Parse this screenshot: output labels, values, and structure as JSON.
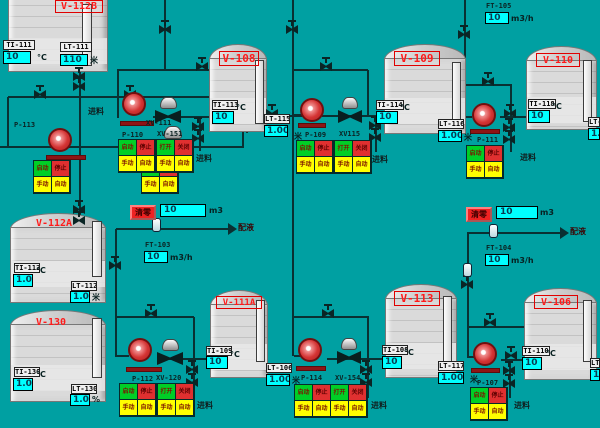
{
  "colors": {
    "background": "#00a0a2",
    "pipe": "#0a3032",
    "value_box": "#00ffff",
    "tank_name": "#ff1a1a",
    "pump_red": "#d43434",
    "cell_green": "#00cf26",
    "cell_red": "#e03030",
    "cell_yellow": "#ffff00",
    "reset_red": "#ee2222"
  },
  "strings": {
    "feed": "进料",
    "dosing": "配液",
    "reset": "清零",
    "unit_m3": "m3",
    "unit_m3h": "m3/h",
    "unit_c": "°C",
    "unit_m": "米",
    "unit_pct": "%"
  },
  "button_labels": {
    "pump": [
      "启动",
      "停止",
      "手动",
      "自动"
    ],
    "valve": [
      "打开",
      "关闭",
      "手动",
      "自动"
    ]
  },
  "tanks": [
    {
      "id": "v112b",
      "name": "V-112B",
      "boxed": true,
      "ti": {
        "tag": "TI-111",
        "value": "10",
        "unit": "°C"
      },
      "lt": {
        "tag": "LT-111",
        "value": "110",
        "unit": "米"
      }
    },
    {
      "id": "v108",
      "name": "V-108",
      "boxed": true,
      "ti": {
        "tag": "TI-113",
        "value": "10",
        "unit": "°C"
      },
      "lt": {
        "tag": "LT-115",
        "value": "1.00",
        "unit": "米"
      }
    },
    {
      "id": "v109",
      "name": "V-109",
      "boxed": true,
      "ti": {
        "tag": "TI-114",
        "value": "10",
        "unit": "°C"
      },
      "lt": {
        "tag": "LT-116",
        "value": "1.00",
        "unit": "米"
      }
    },
    {
      "id": "v110",
      "name": "V-110",
      "boxed": true,
      "ti": {
        "tag": "TI-118",
        "value": "10",
        "unit": "°C"
      },
      "lt": {
        "tag": "LT-1",
        "value": "1.0",
        "unit": ""
      }
    },
    {
      "id": "v112a",
      "name": "V-112A",
      "boxed": false,
      "ti": {
        "tag": "TI-112",
        "value": "1.0",
        "unit": "°C"
      },
      "lt": {
        "tag": "LT-112",
        "value": "1.00",
        "unit": "米"
      }
    },
    {
      "id": "v130",
      "name": "V-130",
      "boxed": false,
      "ti": {
        "tag": "TI-130",
        "value": "1.0",
        "unit": "°C"
      },
      "lt": {
        "tag": "LT-130",
        "value": "1.0",
        "unit": "%"
      }
    },
    {
      "id": "v111a",
      "name": "V-111A",
      "boxed": true,
      "ti": {
        "tag": "TI-109",
        "value": "10",
        "unit": "°C"
      },
      "lt": {
        "tag": "LT-106",
        "value": "1.00",
        "unit": "米"
      }
    },
    {
      "id": "v113",
      "name": "V-113",
      "boxed": true,
      "ti": {
        "tag": "TI-108",
        "value": "10",
        "unit": "°C"
      },
      "lt": {
        "tag": "LT-117",
        "value": "1.00",
        "unit": "米"
      }
    },
    {
      "id": "v106",
      "name": "V-106",
      "boxed": true,
      "ti": {
        "tag": "TI-110",
        "value": "10",
        "unit": "°C"
      },
      "lt": {
        "tag": "LT-1",
        "value": "1.0",
        "unit": ""
      }
    }
  ],
  "pumps": [
    {
      "id": "p113",
      "tag": "P-113"
    },
    {
      "id": "p110",
      "tag": "P-110"
    },
    {
      "id": "p109",
      "tag": "P-109"
    },
    {
      "id": "p111",
      "tag": "P-111"
    },
    {
      "id": "p112",
      "tag": "P-112"
    },
    {
      "id": "p114",
      "tag": "P-114"
    },
    {
      "id": "p107",
      "tag": "P-107"
    }
  ],
  "xvalves": [
    {
      "id": "xv111",
      "tag": "XV-111"
    },
    {
      "id": "xv151",
      "tag": "XV-151"
    },
    {
      "id": "xv115",
      "tag": "XV115"
    },
    {
      "id": "xv120",
      "tag": "XV-120"
    },
    {
      "id": "xv154",
      "tag": "XV-154"
    }
  ],
  "flow_stations": [
    {
      "id": "ft103",
      "tag": "FT-103",
      "value": "10",
      "unit": "m3/h",
      "totalizer": {
        "value": "10",
        "unit": "m3"
      },
      "reset": "清零",
      "arrow_label": "配液"
    },
    {
      "id": "ft104",
      "tag": "FT-104",
      "value": "10",
      "unit": "m3/h",
      "totalizer": {
        "value": "10",
        "unit": "m3"
      },
      "reset": "清零",
      "arrow_label": "配液"
    },
    {
      "id": "ft105",
      "tag": "FT-105",
      "value": "10",
      "unit": "m3/h"
    }
  ],
  "feed_label_count": 7
}
